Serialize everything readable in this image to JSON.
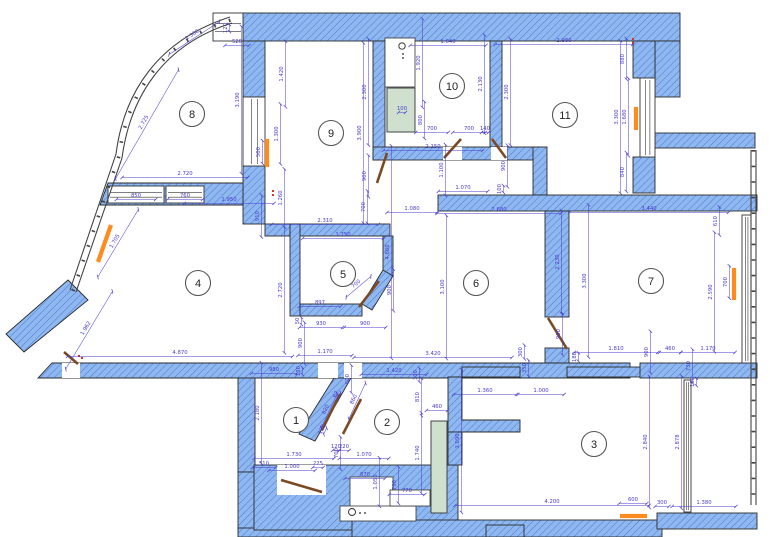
{
  "title": "apartment-floor-plan",
  "colors": {
    "wall_fill": "#8fb8f0",
    "wall_hatch": "#4f7fd0",
    "wall_outline": "#2b2b2b",
    "dim": "#4a3ad0",
    "radiator": "#ff8a1e",
    "door": "#7b4a22",
    "shaft_fill": "#cfe0cf",
    "glazing": "#444444",
    "marker_red": "#e03020",
    "room_circle": "#555555",
    "room_text": "#222222",
    "background": "#ffffff"
  },
  "rooms": [
    {
      "n": "1",
      "x": 296,
      "y": 420
    },
    {
      "n": "2",
      "x": 387,
      "y": 422
    },
    {
      "n": "3",
      "x": 594,
      "y": 444
    },
    {
      "n": "4",
      "x": 198,
      "y": 283
    },
    {
      "n": "5",
      "x": 343,
      "y": 274
    },
    {
      "n": "6",
      "x": 476,
      "y": 283
    },
    {
      "n": "7",
      "x": 651,
      "y": 281
    },
    {
      "n": "8",
      "x": 192,
      "y": 114
    },
    {
      "n": "9",
      "x": 331,
      "y": 133
    },
    {
      "n": "10",
      "x": 452,
      "y": 86
    },
    {
      "n": "11",
      "x": 565,
      "y": 115
    }
  ],
  "plan_scale_px_per_mm": 0.0462,
  "walls": [
    {
      "r": [
        243,
        13,
        437,
        28
      ]
    },
    {
      "r": [
        655,
        41,
        25,
        56
      ]
    },
    {
      "r": [
        633,
        41,
        22,
        37
      ]
    },
    {
      "r": [
        633,
        157,
        22,
        36
      ]
    },
    {
      "r": [
        655,
        133,
        100,
        15
      ]
    },
    {
      "r": [
        243,
        41,
        22,
        56
      ]
    },
    {
      "r": [
        243,
        166,
        22,
        58
      ]
    },
    {
      "p": [
        [
          108,
          183
        ],
        [
          243,
          183
        ],
        [
          243,
          205
        ],
        [
          100,
          205
        ]
      ]
    },
    {
      "p": [
        [
          68,
          280
        ],
        [
          88,
          300
        ],
        [
          24,
          352
        ],
        [
          6,
          334
        ]
      ]
    },
    {
      "r": [
        373,
        41,
        12,
        119
      ]
    },
    {
      "r": [
        490,
        41,
        12,
        106
      ]
    },
    {
      "r": [
        265,
        224,
        125,
        12
      ]
    },
    {
      "r": [
        290,
        224,
        10,
        92
      ]
    },
    {
      "r": [
        373,
        147,
        167,
        13
      ]
    },
    {
      "r": [
        533,
        147,
        14,
        48
      ]
    },
    {
      "r": [
        438,
        195,
        319,
        16
      ]
    },
    {
      "r": [
        545,
        211,
        24,
        106
      ]
    },
    {
      "r": [
        545,
        348,
        24,
        15
      ]
    },
    {
      "r": [
        383,
        236,
        10,
        40
      ]
    },
    {
      "p": [
        [
          383,
          270
        ],
        [
          393,
          276
        ],
        [
          372,
          310
        ],
        [
          362,
          304
        ]
      ]
    },
    {
      "r": [
        300,
        304,
        62,
        12
      ]
    },
    {
      "p": [
        [
          52,
          363
        ],
        [
          630,
          363
        ],
        [
          630,
          378
        ],
        [
          38,
          378
        ]
      ]
    },
    {
      "r": [
        238,
        378,
        17,
        94
      ]
    },
    {
      "r": [
        238,
        472,
        20,
        58
      ]
    },
    {
      "r": [
        238,
        528,
        119,
        9
      ]
    },
    {
      "r": [
        254,
        465,
        204,
        65
      ]
    },
    {
      "p": [
        [
          334,
          378
        ],
        [
          351,
          378
        ],
        [
          315,
          441
        ],
        [
          299,
          434
        ]
      ]
    },
    {
      "p": [
        [
          448,
          377
        ],
        [
          462,
          377
        ],
        [
          462,
          420
        ],
        [
          520,
          420
        ],
        [
          520,
          432
        ],
        [
          448,
          432
        ]
      ]
    },
    {
      "r": [
        448,
        432,
        14,
        33
      ]
    },
    {
      "r": [
        462,
        367,
        58,
        10
      ]
    },
    {
      "r": [
        567,
        367,
        90,
        10
      ]
    },
    {
      "r": [
        640,
        363,
        117,
        15
      ]
    },
    {
      "r": [
        352,
        520,
        310,
        17
      ]
    },
    {
      "r": [
        657,
        513,
        100,
        16
      ]
    },
    {
      "r": [
        486,
        525,
        38,
        12
      ]
    }
  ],
  "cutouts": [
    {
      "r": [
        277,
        465,
        49,
        30
      ],
      "s": 0
    },
    {
      "r": [
        350,
        477,
        43,
        39
      ],
      "s": 1
    },
    {
      "r": [
        340,
        506,
        76,
        15
      ],
      "s": 1
    },
    {
      "r": [
        390,
        490,
        40,
        16
      ],
      "s": 1
    },
    {
      "r": [
        443,
        147,
        19,
        13
      ],
      "s": 0
    },
    {
      "r": [
        491,
        147,
        16,
        13
      ],
      "s": 0
    },
    {
      "r": [
        62,
        363,
        18,
        15
      ],
      "s": 0
    },
    {
      "r": [
        318,
        363,
        20,
        15
      ],
      "s": 0
    },
    {
      "r": [
        344,
        363,
        18,
        15
      ],
      "s": 0
    },
    {
      "r": [
        385,
        38,
        30,
        49
      ],
      "s": 1
    }
  ],
  "windows": [
    {
      "r": [
        213,
        13,
        30,
        28
      ],
      "o": "h"
    },
    {
      "r": [
        243,
        97,
        22,
        69
      ],
      "o": "v"
    },
    {
      "r": [
        108,
        186,
        56,
        17
      ],
      "o": "h"
    },
    {
      "r": [
        166,
        186,
        38,
        17
      ],
      "o": "h"
    },
    {
      "r": [
        640,
        78,
        15,
        79
      ],
      "o": "v"
    },
    {
      "r": [
        742,
        215,
        9,
        148
      ],
      "o": "v"
    },
    {
      "r": [
        684,
        380,
        7,
        132
      ],
      "o": "v"
    }
  ],
  "glazing": [
    {
      "d": "M 70,290 L 116,154 C 124,92 158,40 230,17",
      "m": 0
    },
    {
      "d": "M 76,292 L 122,158 C 130,98 162,45 232,23",
      "m": 0
    },
    {
      "d": "M 73,291 L 119,156 C 127,95 160,42 231,20",
      "m": 1
    },
    {
      "d": "M 751,150 L 751,505",
      "m": 0
    },
    {
      "d": "M 756,150 L 756,505",
      "m": 0
    },
    {
      "d": "M 753.5,150 L 753.5,505",
      "m": 1
    }
  ],
  "shafts": [
    {
      "r": [
        387,
        88,
        28,
        44
      ]
    },
    {
      "r": [
        431,
        421,
        16,
        92
      ]
    }
  ],
  "radiators": [
    [
      98,
      262,
      111,
      225
    ],
    [
      267,
      139,
      267,
      167
    ],
    [
      636,
      107,
      636,
      130
    ],
    [
      734,
      268,
      734,
      300
    ],
    [
      620,
      516,
      647,
      516
    ]
  ],
  "doors": [
    [
      281,
      480,
      322,
      492
    ],
    [
      322,
      430,
      340,
      394
    ],
    [
      343,
      434,
      361,
      399
    ],
    [
      444,
      158,
      461,
      139
    ],
    [
      492,
      139,
      506,
      158
    ],
    [
      548,
      318,
      567,
      349
    ],
    [
      377,
      183,
      387,
      153
    ],
    [
      359,
      307,
      379,
      281
    ],
    [
      64,
      352,
      78,
      364
    ]
  ],
  "vents": [
    {
      "c": [
        402,
        46
      ],
      "rad": 3.2,
      "dots": [
        [
          403,
          54
        ],
        [
          403,
          58
        ]
      ]
    },
    {
      "c": [
        352,
        512
      ],
      "rad": 3.5,
      "dots": [
        [
          360,
          513
        ],
        [
          365,
          513
        ]
      ]
    }
  ],
  "red_markers": [
    [
      272,
      190
    ],
    [
      272,
      194
    ],
    [
      632,
      38
    ],
    [
      632,
      42
    ],
    [
      78,
      355
    ],
    [
      81,
      357
    ]
  ],
  "dimensions": [
    {
      "t": "1.300",
      "x": 193,
      "y": 36,
      "a": -33
    },
    {
      "t": "120",
      "x": 227,
      "y": 28,
      "a": -90
    },
    {
      "t": "520",
      "x": 237,
      "y": 43,
      "a": 0
    },
    {
      "t": "3.190",
      "x": 239,
      "y": 100,
      "a": -90
    },
    {
      "t": "2.725",
      "x": 145,
      "y": 123,
      "a": -60
    },
    {
      "t": "2.720",
      "x": 185,
      "y": 175,
      "a": 0
    },
    {
      "t": "850",
      "x": 136,
      "y": 197,
      "a": 0
    },
    {
      "t": "760",
      "x": 185,
      "y": 197,
      "a": 0
    },
    {
      "t": "1.950",
      "x": 229,
      "y": 201,
      "a": 0
    },
    {
      "t": "1.260",
      "x": 282,
      "y": 198,
      "a": -90
    },
    {
      "t": "910",
      "x": 259,
      "y": 216,
      "a": -90
    },
    {
      "t": "1.420",
      "x": 283,
      "y": 74,
      "a": -90
    },
    {
      "t": "1.300",
      "x": 278,
      "y": 134,
      "a": -90
    },
    {
      "t": "500",
      "x": 260,
      "y": 152,
      "a": -90
    },
    {
      "t": "2.300",
      "x": 366,
      "y": 92,
      "a": -90
    },
    {
      "t": "3.900",
      "x": 361,
      "y": 133,
      "a": -90
    },
    {
      "t": "900",
      "x": 366,
      "y": 176,
      "a": -90
    },
    {
      "t": "2.310",
      "x": 325,
      "y": 222,
      "a": 0
    },
    {
      "t": "700",
      "x": 365,
      "y": 207,
      "a": -90
    },
    {
      "t": "1.750",
      "x": 343,
      "y": 236,
      "a": 0
    },
    {
      "t": "100",
      "x": 402,
      "y": 110,
      "a": 0
    },
    {
      "t": "700",
      "x": 432,
      "y": 130,
      "a": 0
    },
    {
      "t": "700",
      "x": 469,
      "y": 130,
      "a": 0
    },
    {
      "t": "140",
      "x": 485,
      "y": 130,
      "a": 0
    },
    {
      "t": "1.640",
      "x": 448,
      "y": 43,
      "a": 0
    },
    {
      "t": "1.920",
      "x": 420,
      "y": 63,
      "a": -90
    },
    {
      "t": "2.130",
      "x": 482,
      "y": 84,
      "a": -90
    },
    {
      "t": "800",
      "x": 422,
      "y": 120,
      "a": -90
    },
    {
      "t": "2.150",
      "x": 433,
      "y": 148,
      "a": 0
    },
    {
      "t": "1.100",
      "x": 443,
      "y": 170,
      "a": -90
    },
    {
      "t": "1.070",
      "x": 463,
      "y": 189,
      "a": 0
    },
    {
      "t": "100",
      "x": 501,
      "y": 189,
      "a": -90
    },
    {
      "t": "900",
      "x": 505,
      "y": 166,
      "a": -90
    },
    {
      "t": "2.980",
      "x": 564,
      "y": 42,
      "a": 0
    },
    {
      "t": "880",
      "x": 624,
      "y": 59,
      "a": -90
    },
    {
      "t": "2.300",
      "x": 508,
      "y": 92,
      "a": -90
    },
    {
      "t": "3.300",
      "x": 618,
      "y": 117,
      "a": -90
    },
    {
      "t": "1.680",
      "x": 626,
      "y": 117,
      "a": -90
    },
    {
      "t": "840",
      "x": 624,
      "y": 172,
      "a": -90
    },
    {
      "t": "1.705",
      "x": 116,
      "y": 242,
      "a": -59
    },
    {
      "t": "1.962",
      "x": 87,
      "y": 329,
      "a": -59
    },
    {
      "t": "2.720",
      "x": 282,
      "y": 290,
      "a": -90
    },
    {
      "t": "4.870",
      "x": 180,
      "y": 354,
      "a": 0
    },
    {
      "t": "980",
      "x": 274,
      "y": 371,
      "a": 0
    },
    {
      "t": "4.600",
      "x": 389,
      "y": 252,
      "a": -90
    },
    {
      "t": "700",
      "x": 357,
      "y": 285,
      "a": -40
    },
    {
      "t": "900",
      "x": 391,
      "y": 290,
      "a": -90
    },
    {
      "t": "897",
      "x": 320,
      "y": 304,
      "a": 0
    },
    {
      "t": "930",
      "x": 321,
      "y": 325,
      "a": 0
    },
    {
      "t": "900",
      "x": 365,
      "y": 325,
      "a": 0
    },
    {
      "t": "50",
      "x": 299,
      "y": 321,
      "a": -90
    },
    {
      "t": "900",
      "x": 302,
      "y": 343,
      "a": -90
    },
    {
      "t": "1.170",
      "x": 325,
      "y": 353,
      "a": 0
    },
    {
      "t": "130",
      "x": 300,
      "y": 371,
      "a": -90
    },
    {
      "t": "1.080",
      "x": 412,
      "y": 210,
      "a": 0
    },
    {
      "t": "2.680",
      "x": 499,
      "y": 211,
      "a": 0
    },
    {
      "t": "3.100",
      "x": 444,
      "y": 287,
      "a": -90
    },
    {
      "t": "2.230",
      "x": 559,
      "y": 262,
      "a": -90
    },
    {
      "t": "3.300",
      "x": 586,
      "y": 281,
      "a": -90
    },
    {
      "t": "900",
      "x": 560,
      "y": 334,
      "a": -90
    },
    {
      "t": "180",
      "x": 576,
      "y": 357,
      "a": -90
    },
    {
      "t": "3.420",
      "x": 433,
      "y": 355,
      "a": 0
    },
    {
      "t": "300",
      "x": 522,
      "y": 352,
      "a": -90
    },
    {
      "t": "1.420",
      "x": 394,
      "y": 372,
      "a": 0
    },
    {
      "t": "3.440",
      "x": 649,
      "y": 210,
      "a": 0
    },
    {
      "t": "610",
      "x": 717,
      "y": 221,
      "a": -90
    },
    {
      "t": "2.590",
      "x": 712,
      "y": 292,
      "a": -90
    },
    {
      "t": "700",
      "x": 727,
      "y": 282,
      "a": -90
    },
    {
      "t": "1.810",
      "x": 616,
      "y": 350,
      "a": 0
    },
    {
      "t": "900",
      "x": 648,
      "y": 352,
      "a": -90
    },
    {
      "t": "460",
      "x": 670,
      "y": 350,
      "a": 0
    },
    {
      "t": "1.170",
      "x": 708,
      "y": 350,
      "a": 0
    },
    {
      "t": "730",
      "x": 690,
      "y": 366,
      "a": -90
    },
    {
      "t": "160",
      "x": 694,
      "y": 382,
      "a": -90
    },
    {
      "t": "2.180",
      "x": 259,
      "y": 413,
      "a": -90
    },
    {
      "t": "1.730",
      "x": 294,
      "y": 456,
      "a": 0
    },
    {
      "t": "510",
      "x": 264,
      "y": 465,
      "a": 0
    },
    {
      "t": "1.000",
      "x": 292,
      "y": 468,
      "a": 0
    },
    {
      "t": "225",
      "x": 318,
      "y": 465,
      "a": 0
    },
    {
      "t": "120",
      "x": 323,
      "y": 430,
      "a": -65
    },
    {
      "t": "820",
      "x": 327,
      "y": 410,
      "a": -65
    },
    {
      "t": "62",
      "x": 337,
      "y": 395,
      "a": -65
    },
    {
      "t": "600",
      "x": 349,
      "y": 379,
      "a": -90
    },
    {
      "t": "860",
      "x": 355,
      "y": 400,
      "a": -65
    },
    {
      "t": "700",
      "x": 338,
      "y": 453,
      "a": -90
    },
    {
      "t": "220",
      "x": 344,
      "y": 448,
      "a": 0
    },
    {
      "t": "300",
      "x": 417,
      "y": 375,
      "a": -90
    },
    {
      "t": "810",
      "x": 419,
      "y": 397,
      "a": -90
    },
    {
      "t": "460",
      "x": 437,
      "y": 408,
      "a": 0
    },
    {
      "t": "1.740",
      "x": 419,
      "y": 453,
      "a": -90
    },
    {
      "t": "1.070",
      "x": 364,
      "y": 456,
      "a": 0
    },
    {
      "t": "870",
      "x": 365,
      "y": 476,
      "a": 0
    },
    {
      "t": "1.050",
      "x": 377,
      "y": 482,
      "a": -90
    },
    {
      "t": "790",
      "x": 396,
      "y": 485,
      "a": -90
    },
    {
      "t": "770",
      "x": 407,
      "y": 492,
      "a": 0
    },
    {
      "t": "120",
      "x": 336,
      "y": 448,
      "a": 0
    },
    {
      "t": "1.360",
      "x": 485,
      "y": 392,
      "a": 0
    },
    {
      "t": "1.000",
      "x": 541,
      "y": 392,
      "a": 0
    },
    {
      "t": "350",
      "x": 526,
      "y": 368,
      "a": -90
    },
    {
      "t": "3.090",
      "x": 459,
      "y": 441,
      "a": -90
    },
    {
      "t": "2.840",
      "x": 647,
      "y": 442,
      "a": -90
    },
    {
      "t": "2.878",
      "x": 679,
      "y": 442,
      "a": -90
    },
    {
      "t": "4.200",
      "x": 552,
      "y": 503,
      "a": 0
    },
    {
      "t": "600",
      "x": 633,
      "y": 501,
      "a": 0
    },
    {
      "t": "300",
      "x": 662,
      "y": 504,
      "a": 0
    },
    {
      "t": "1.380",
      "x": 704,
      "y": 504,
      "a": 0
    }
  ]
}
